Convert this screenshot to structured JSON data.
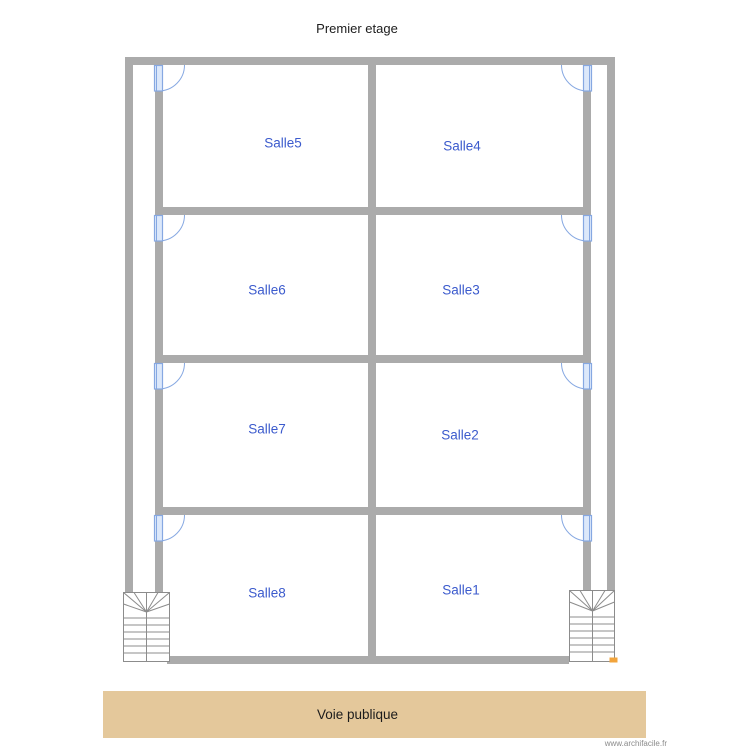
{
  "title": "Premier etage",
  "rooms": [
    {
      "name": "Salle5"
    },
    {
      "name": "Salle4"
    },
    {
      "name": "Salle6"
    },
    {
      "name": "Salle3"
    },
    {
      "name": "Salle7"
    },
    {
      "name": "Salle2"
    },
    {
      "name": "Salle8"
    },
    {
      "name": "Salle1"
    }
  ],
  "street": {
    "label": "Voie publique"
  },
  "watermark": "www.archifacile.fr",
  "colors": {
    "wall": "#ababab",
    "stair": "#8c8c8c",
    "door": "#86a8e2",
    "doorfill": "#dce8fa",
    "label": "#3c5bcd",
    "street": "#e4c89b",
    "marker": "#f2a43c",
    "watermark": "#8a8a8a",
    "title": "#1c1c1c"
  }
}
